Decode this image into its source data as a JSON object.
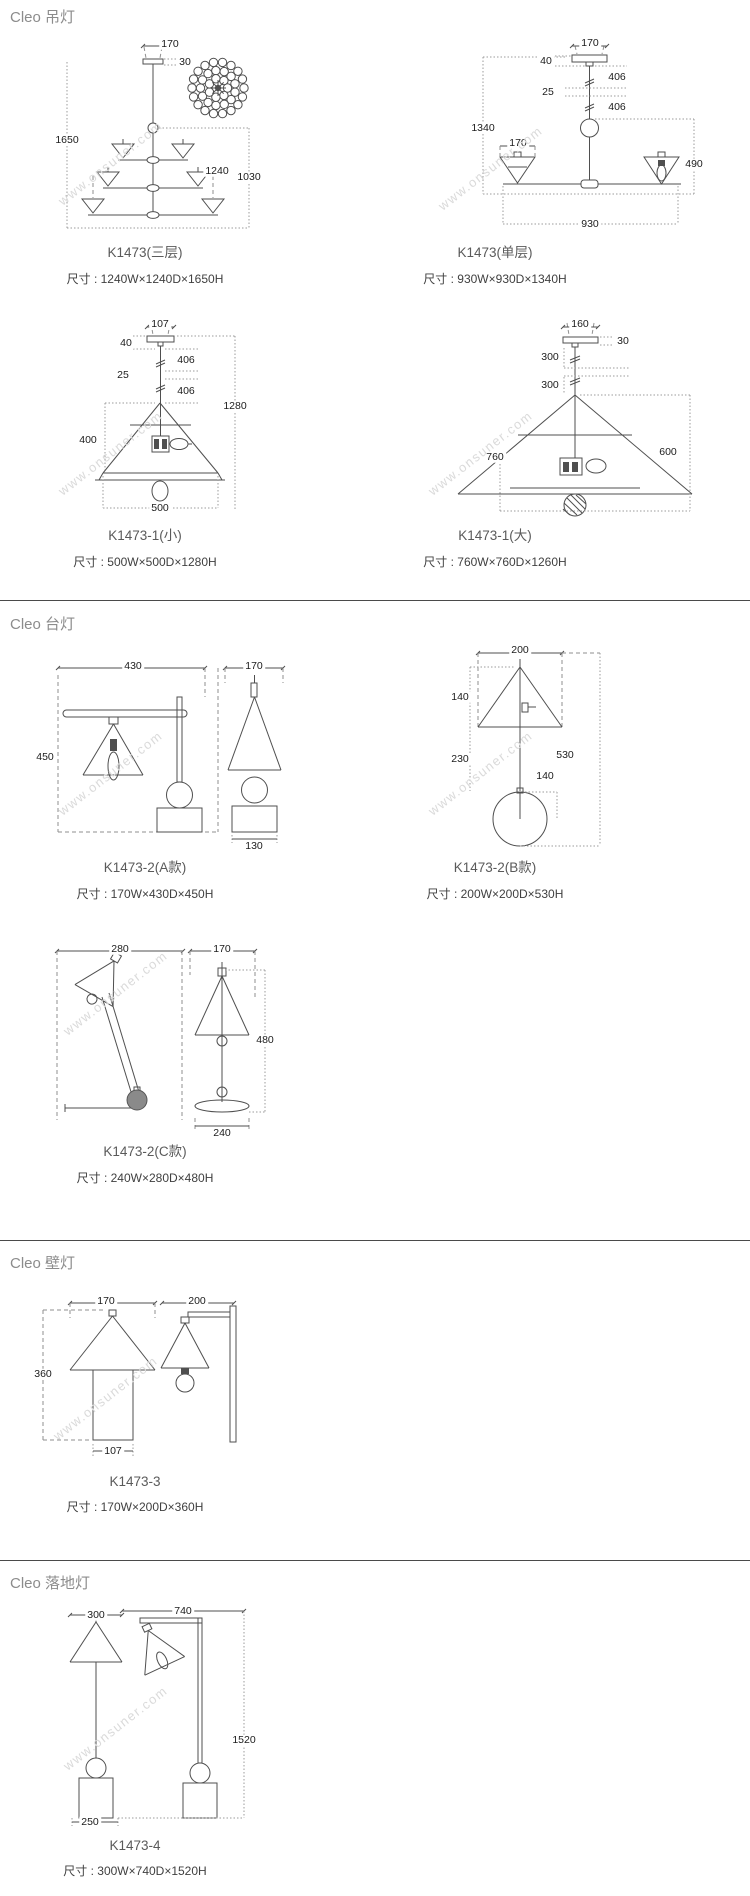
{
  "watermark": "www.onsuner.com",
  "sections": {
    "pendant": {
      "title": "Cleo 吊灯"
    },
    "table": {
      "title": "Cleo 台灯"
    },
    "wall": {
      "title": "Cleo 壁灯"
    },
    "floor": {
      "title": "Cleo 落地灯"
    }
  },
  "products": {
    "p3tier": {
      "name": "K1473(三层)",
      "size": "尺寸 : 1240W×1240D×1650H",
      "dims": {
        "canopy_w": "170",
        "canopy_h": "30",
        "total_h": "1650",
        "width": "1240",
        "body_h": "1030"
      }
    },
    "p1tier": {
      "name": "K1473(单层)",
      "size": "尺寸 : 930W×930D×1340H",
      "dims": {
        "canopy_w": "170",
        "canopy_h": "40",
        "rod_upper": "406",
        "rod_gap": "25",
        "rod_lower": "406",
        "total_h": "1340",
        "shade_w": "170",
        "arm_drop": "490",
        "width": "930"
      }
    },
    "small": {
      "name": "K1473-1(小)",
      "size": "尺寸 : 500W×500D×1280H",
      "dims": {
        "canopy_w": "107",
        "canopy_h": "40",
        "rod_upper": "406",
        "rod_gap": "25",
        "rod_lower": "406",
        "total_h": "1280",
        "shade_h": "400",
        "width": "500"
      }
    },
    "large": {
      "name": "K1473-1(大)",
      "size": "尺寸 : 760W×760D×1260H",
      "dims": {
        "canopy_w": "160",
        "canopy_h": "30",
        "rod_upper": "300",
        "rod_lower": "300",
        "width": "760",
        "shade_h": "600"
      }
    },
    "ta": {
      "name": "K1473-2(A款)",
      "size": "尺寸 : 170W×430D×450H",
      "dims": {
        "depth": "430",
        "width": "170",
        "height": "450",
        "base_w": "130"
      }
    },
    "tb": {
      "name": "K1473-2(B款)",
      "size": "尺寸 : 200W×200D×530H",
      "dims": {
        "width": "200",
        "shade_h": "140",
        "stem_h": "230",
        "total_h": "530",
        "ball_d": "140"
      }
    },
    "tc": {
      "name": "K1473-2(C款)",
      "size": "尺寸 : 240W×280D×480H",
      "dims": {
        "depth": "280",
        "width": "170",
        "height": "480",
        "base_w": "240"
      }
    },
    "wl": {
      "name": "K1473-3",
      "size": "尺寸 : 170W×200D×360H",
      "dims": {
        "width": "170",
        "depth": "200",
        "height": "360",
        "base_w": "107"
      }
    },
    "fl": {
      "name": "K1473-4",
      "size": "尺寸 : 300W×740D×1520H",
      "dims": {
        "shade_w": "300",
        "depth": "740",
        "height": "1520",
        "base_w": "250"
      }
    }
  }
}
